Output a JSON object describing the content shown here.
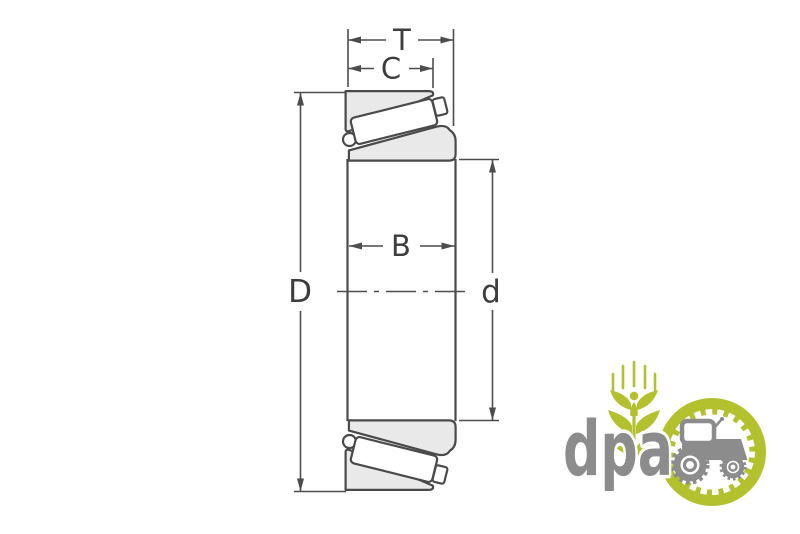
{
  "diagram": {
    "type": "tapered-roller-bearing-cross-section",
    "labels": {
      "total_width": "T",
      "cup_width": "C",
      "cone_width": "B",
      "outer_diameter": "D",
      "bore_diameter": "d"
    },
    "colors": {
      "line": "#4a4a4a",
      "dimension_line": "#4d4d4d",
      "ring_fill": "#e9e9e9",
      "roller_fill": "#ffffff",
      "label_text": "#3d3d3d"
    }
  },
  "watermark": {
    "brand": "dpa",
    "colors": {
      "green": "#b4c12e",
      "gray": "#8c8c8c"
    }
  }
}
